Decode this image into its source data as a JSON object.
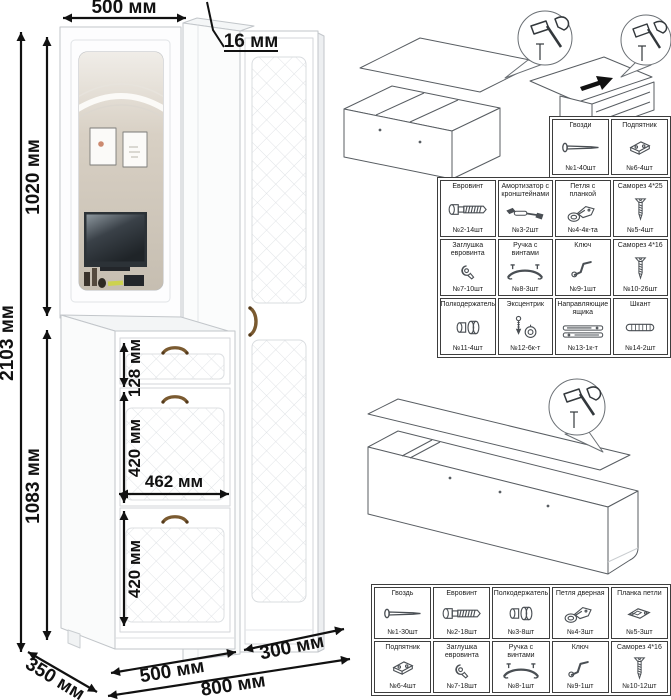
{
  "dimensions": {
    "total_height": "2103 мм",
    "upper_section_height": "1020 мм",
    "lower_section_height": "1083 мм",
    "top_width": "500 мм",
    "panel_thickness": "16 мм",
    "drawer_height": "128 мм",
    "flap_top_height": "420 мм",
    "inner_width": "462 мм",
    "flap_bottom_height": "420 мм",
    "depth": "350 мм",
    "left_section_width": "500 мм",
    "right_section_width": "300 мм",
    "total_width": "800 мм"
  },
  "hardware_tables": {
    "top": {
      "cells": [
        {
          "name": "Гвозди",
          "qty": "№1-40шт",
          "icon": "nail"
        },
        {
          "name": "Подпятник",
          "qty": "№6-4шт",
          "icon": "footplate"
        }
      ]
    },
    "main": {
      "cells": [
        {
          "name": "Евровинт",
          "qty": "№2-14шт",
          "icon": "eurobolt"
        },
        {
          "name": "Амортизатор с кронштейнами",
          "qty": "№3-2шт",
          "icon": "damper"
        },
        {
          "name": "Петля с планкой",
          "qty": "№4-4к-та",
          "icon": "hinge"
        },
        {
          "name": "Саморез 4*25",
          "qty": "№5-4шт",
          "icon": "screw"
        },
        {
          "name": "Заглушка евровинта",
          "qty": "№7-10шт",
          "icon": "plug"
        },
        {
          "name": "Ручка с винтами",
          "qty": "№8-3шт",
          "icon": "handle"
        },
        {
          "name": "Ключ",
          "qty": "№9-1шт",
          "icon": "key"
        },
        {
          "name": "Саморез 4*16",
          "qty": "№10-26шт",
          "icon": "screw"
        },
        {
          "name": "Полкодержатель",
          "qty": "№11-4шт",
          "icon": "shelfpin"
        },
        {
          "name": "Эксцентрик",
          "qty": "№12-6к-т",
          "icon": "cam"
        },
        {
          "name": "Направляющие ящика",
          "qty": "№13-1к-т",
          "icon": "slides"
        },
        {
          "name": "Шкант",
          "qty": "№14-2шт",
          "icon": "dowel"
        }
      ]
    },
    "bottom": {
      "cells": [
        {
          "name": "Гвоздь",
          "qty": "№1-30шт",
          "icon": "nail"
        },
        {
          "name": "Евровинт",
          "qty": "№2-18шт",
          "icon": "eurobolt"
        },
        {
          "name": "Полкодержатель",
          "qty": "№3-8шт",
          "icon": "shelfpin"
        },
        {
          "name": "Петля дверная",
          "qty": "№4-3шт",
          "icon": "hinge"
        },
        {
          "name": "Планка петли",
          "qty": "№5-3шт",
          "icon": "hingeplate"
        },
        {
          "name": "Подпятник",
          "qty": "№6-4шт",
          "icon": "footplate"
        },
        {
          "name": "Заглушка евровинта",
          "qty": "№7-18шт",
          "icon": "plug"
        },
        {
          "name": "Ручка с винтами",
          "qty": "№8-1шт",
          "icon": "handle"
        },
        {
          "name": "Ключ",
          "qty": "№9-1шт",
          "icon": "key"
        },
        {
          "name": "Саморез 4*16",
          "qty": "№10-12шт",
          "icon": "screw"
        }
      ]
    }
  },
  "colors": {
    "dimension_text": "#111111",
    "furniture_outline": "#c2c6ca",
    "handle_bronze": "#7a5a30",
    "table_border": "#3d3d3d",
    "mirror_wall_beige": "#cbc3b6",
    "line_art": "#585d62"
  }
}
